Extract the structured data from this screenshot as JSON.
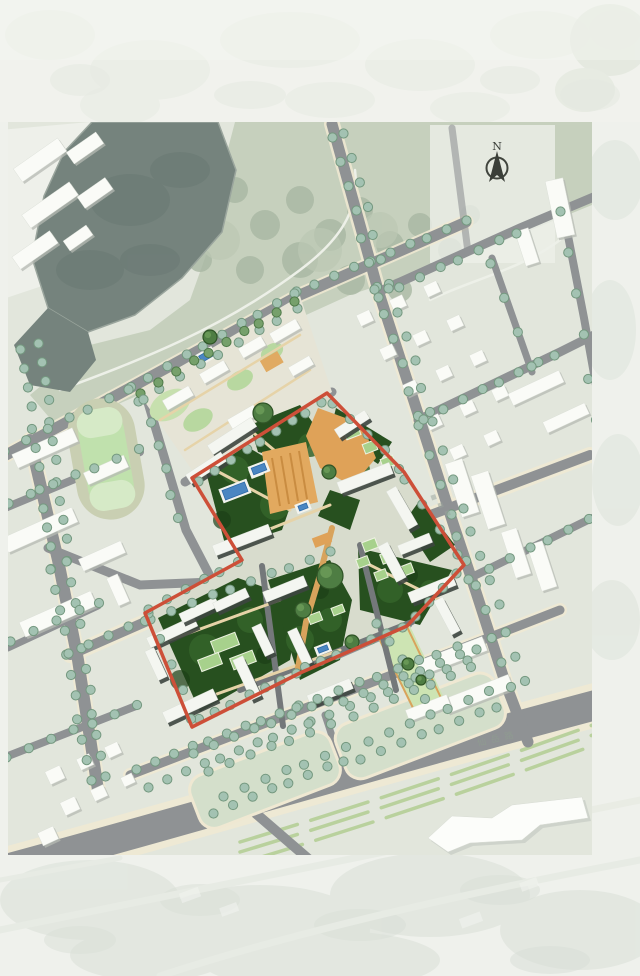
{
  "map": {
    "kind": "residential masterplan site plan",
    "compass": {
      "label": "N"
    },
    "road_label": {
      "text": "仙岳路"
    },
    "colors": {
      "site_boundary_red": "#cd4f38",
      "plaza_orange": "#dfa258",
      "pool_blue": "#4a86c2",
      "site_dark_green": "#27501f",
      "lawn_green": "#a7d18c",
      "tree_sage": "#a3c2b2",
      "road_gray": "#8f9294",
      "sidewalk_cream": "#f0e9d2",
      "water_gray_green": "#75837d",
      "track_infield_green": "#c0e1ad",
      "building_white": "#f7f8f4",
      "background_pale": "#e9ece5"
    }
  }
}
